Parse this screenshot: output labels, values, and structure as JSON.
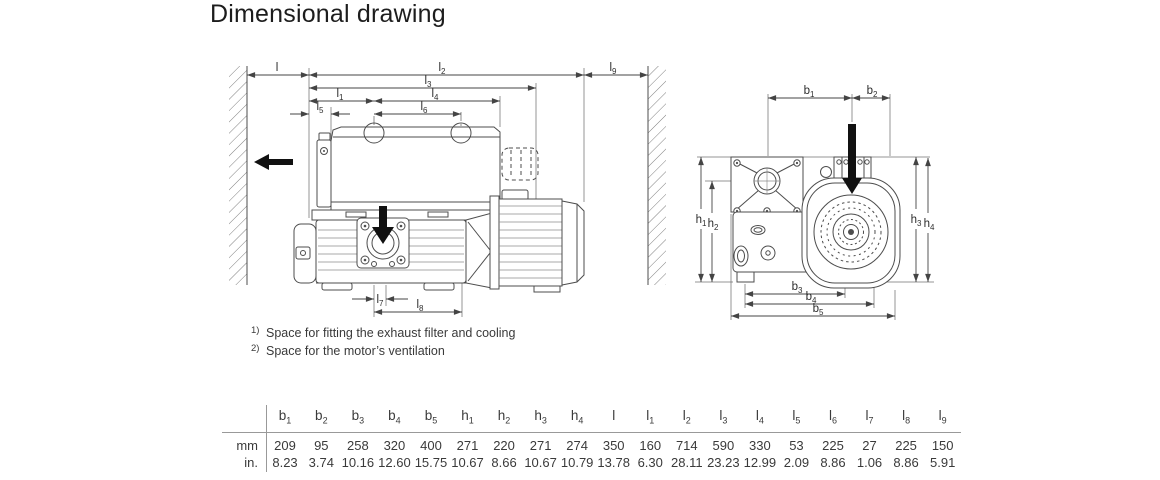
{
  "title": "Dimensional drawing",
  "footnotes": [
    {
      "marker": "1)",
      "text": "Space for fitting the exhaust filter and cooling"
    },
    {
      "marker": "2)",
      "text": "Space for the motor’s ventilation"
    }
  ],
  "dims": {
    "order": [
      "b1",
      "b2",
      "b3",
      "b4",
      "b5",
      "h1",
      "h2",
      "h3",
      "h4",
      "l",
      "l1",
      "l2",
      "l3",
      "l4",
      "l5",
      "l6",
      "l7",
      "l8",
      "l9"
    ],
    "labels": {
      "b1": {
        "base": "b",
        "sub": "1"
      },
      "b2": {
        "base": "b",
        "sub": "2"
      },
      "b3": {
        "base": "b",
        "sub": "3"
      },
      "b4": {
        "base": "b",
        "sub": "4"
      },
      "b5": {
        "base": "b",
        "sub": "5"
      },
      "h1": {
        "base": "h",
        "sub": "1"
      },
      "h2": {
        "base": "h",
        "sub": "2"
      },
      "h3": {
        "base": "h",
        "sub": "3"
      },
      "h4": {
        "base": "h",
        "sub": "4"
      },
      "l": {
        "base": "l",
        "sub": ""
      },
      "l1": {
        "base": "l",
        "sub": "1"
      },
      "l2": {
        "base": "l",
        "sub": "2"
      },
      "l3": {
        "base": "l",
        "sub": "3"
      },
      "l4": {
        "base": "l",
        "sub": "4"
      },
      "l5": {
        "base": "l",
        "sub": "5"
      },
      "l6": {
        "base": "l",
        "sub": "6"
      },
      "l7": {
        "base": "l",
        "sub": "7"
      },
      "l8": {
        "base": "l",
        "sub": "8"
      },
      "l9": {
        "base": "l",
        "sub": "9"
      }
    }
  },
  "table": {
    "rows": [
      {
        "unit": "mm",
        "values": [
          "209",
          "95",
          "258",
          "320",
          "400",
          "271",
          "220",
          "271",
          "274",
          "350",
          "160",
          "714",
          "590",
          "330",
          "53",
          "225",
          "27",
          "225",
          "150"
        ]
      },
      {
        "unit": "in.",
        "values": [
          "8.23",
          "3.74",
          "10.16",
          "12.60",
          "15.75",
          "10.67",
          "8.66",
          "10.67",
          "10.79",
          "13.78",
          "6.30",
          "28.11",
          "23.23",
          "12.99",
          "2.09",
          "8.86",
          "1.06",
          "8.86",
          "5.91"
        ]
      }
    ]
  },
  "colors": {
    "line": "#4d4d4d",
    "text": "#333333",
    "solid_arrow": "#111111"
  }
}
